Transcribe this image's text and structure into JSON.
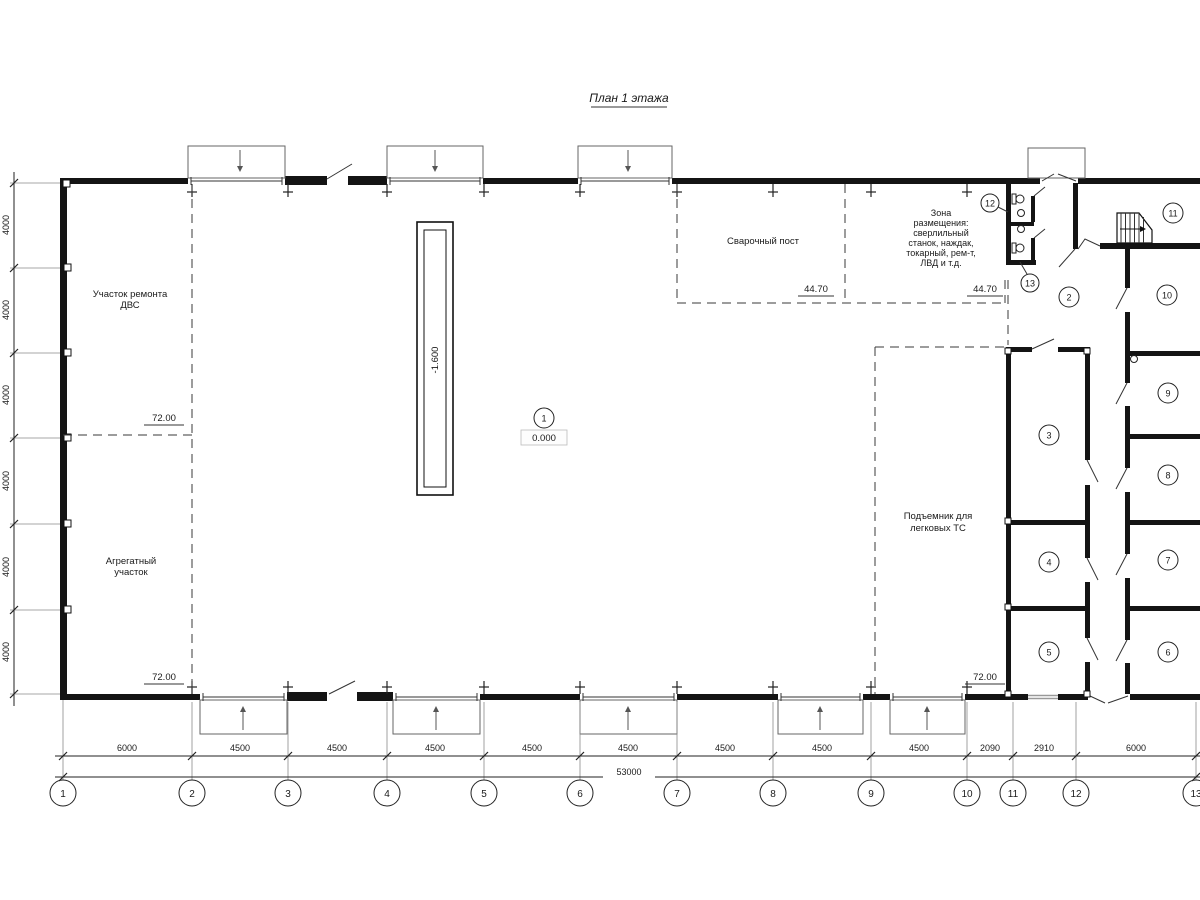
{
  "title": "План 1 этажа",
  "areas": {
    "engine_repair": [
      "Участок ремонта",
      "ДВС"
    ],
    "aggregate": [
      "Агрегатный",
      "участок"
    ],
    "welding": "Сварочный пост",
    "equipment_zone": [
      "Зона",
      "размещения:",
      "сверлильный",
      "станок, наждак,",
      "токарный, рем-т,",
      "ЛВД и т.д."
    ],
    "car_lift": [
      "Подъемник для",
      "легковых ТС"
    ]
  },
  "elevations": {
    "left_top": "72.00",
    "left_bottom": "72.00",
    "right_bottom": "72.00",
    "welding_left": "44.70",
    "welding_right": "44.70",
    "hall_level": "0.000",
    "pit_depth": "-1.600"
  },
  "room_numbers": [
    "1",
    "2",
    "3",
    "4",
    "5",
    "6",
    "7",
    "8",
    "9",
    "10",
    "11",
    "12",
    "13"
  ],
  "grid_axes": [
    "1",
    "2",
    "3",
    "4",
    "5",
    "6",
    "7",
    "8",
    "9",
    "10",
    "11",
    "12",
    "13"
  ],
  "dimensions": {
    "bottom_segments": [
      "6000",
      "4500",
      "4500",
      "4500",
      "4500",
      "4500",
      "4500",
      "4500",
      "4500",
      "2090",
      "2910",
      "6000"
    ],
    "bottom_total": "53000",
    "left_segments": [
      "4000",
      "4000",
      "4000",
      "4000",
      "4000",
      "4000"
    ]
  }
}
